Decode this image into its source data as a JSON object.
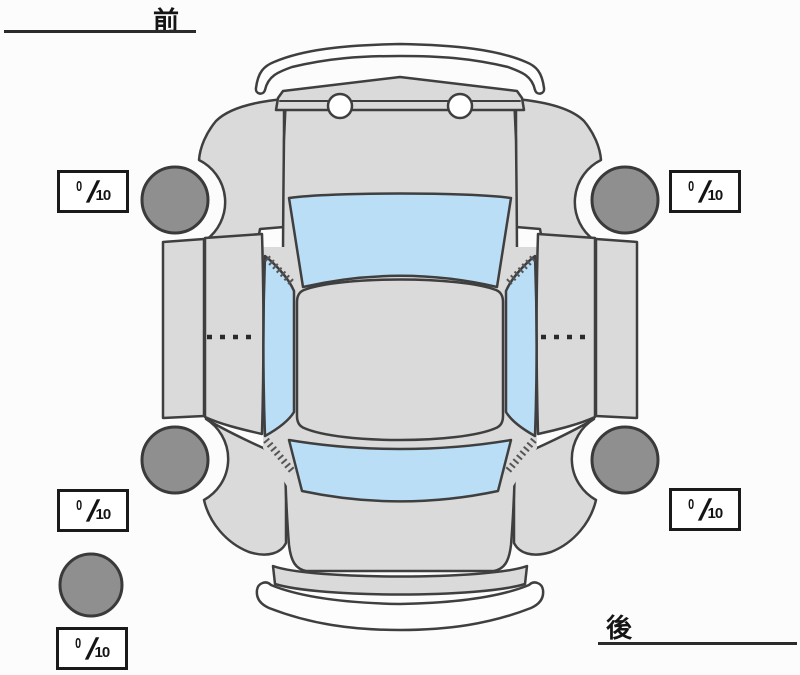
{
  "diagram": {
    "front_label": "前",
    "rear_label": "後",
    "slash": "/",
    "denominator": "10",
    "treads": {
      "front_left": "0",
      "front_right": "0",
      "rear_left": "0",
      "rear_right": "0",
      "spare": "0"
    }
  },
  "colors": {
    "body": "#dadada",
    "glass": "#badef6",
    "tire": "#8f8f8f",
    "outline": "#3f3f3f",
    "label_border": "#1a1a1a"
  }
}
